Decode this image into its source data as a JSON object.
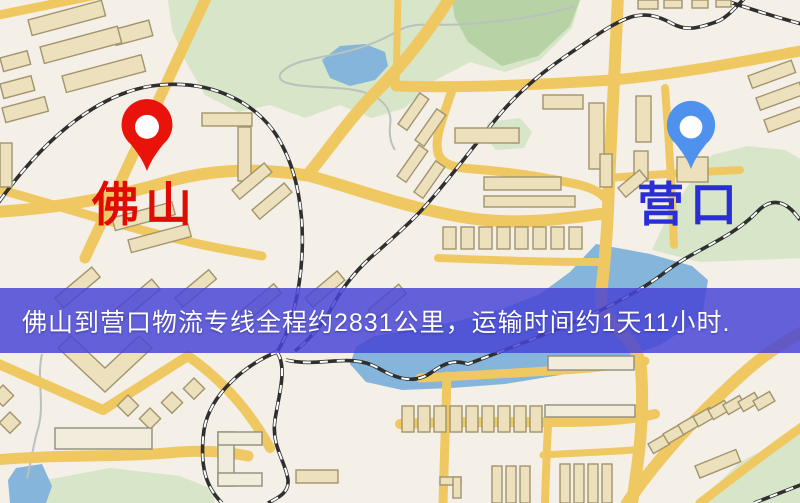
{
  "banner": {
    "text": "佛山到营口物流专线全程约2831公里，运输时间约1天11小时.",
    "bg_color": "#4844d6",
    "text_color": "#ffffff"
  },
  "origin": {
    "name": "佛山",
    "pin_color": "#ea130b",
    "label_color": "#e00b02"
  },
  "destination": {
    "name": "营口",
    "pin_color": "#4e92ee",
    "label_color": "#2a2ed6"
  },
  "map_colors": {
    "land": "#f4efe7",
    "park": "#d7e5c8",
    "park_dark": "#b7d2a4",
    "water": "#85b5da",
    "road": "#f0c862",
    "railway": "#2f2f2f",
    "building_fill": "#ece0bd",
    "building_stroke": "#a2946c",
    "stream": "#b9c2bd"
  }
}
